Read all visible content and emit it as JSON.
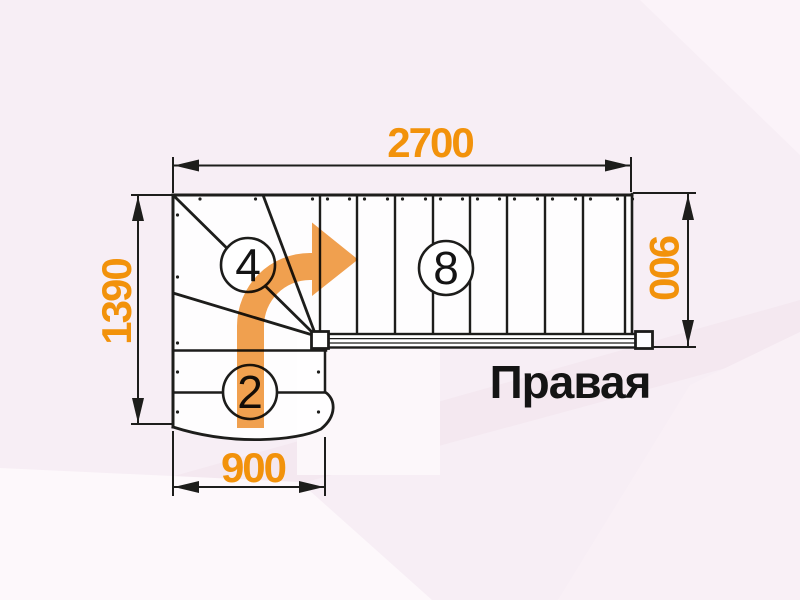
{
  "drawing": {
    "title_label": "Правая",
    "dimensions": {
      "top_width_mm": "2700",
      "left_height_mm": "1390",
      "right_width_mm": "900",
      "bottom_width_mm": "900"
    },
    "step_counts": {
      "winder_flight": "4",
      "upper_flight": "8",
      "lower_flight": "2"
    },
    "colors": {
      "dimension_text": "#f2920b",
      "direction_arrow": "#f1a14f",
      "outline": "#1d1d1b",
      "label_text": "#141414",
      "background": "#f7eef5"
    }
  }
}
